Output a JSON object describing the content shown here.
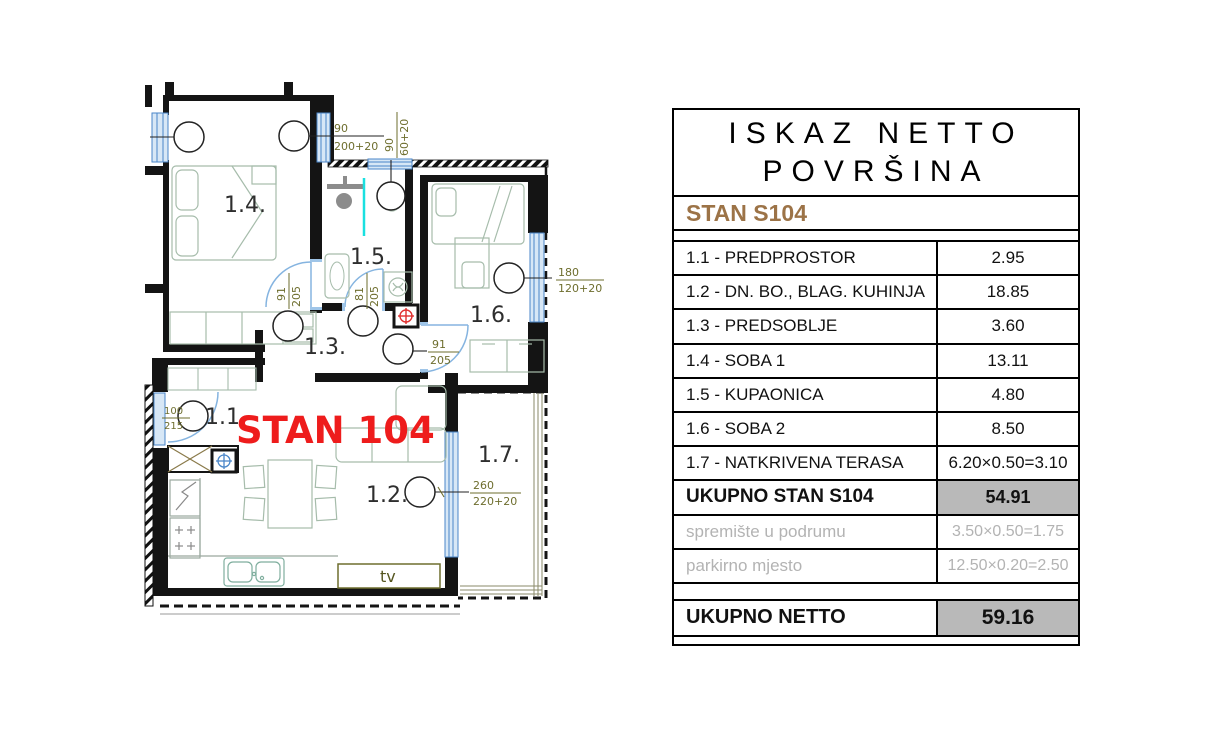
{
  "colors": {
    "accent_brown": "#9c7347",
    "highlight_red": "#ee1c1c",
    "total_cell_gray": "#b9b9b9",
    "muted_text": "#b3b3b3",
    "annotation_olive": "#6e6e2e",
    "window_blue": "#5b93c9"
  },
  "panel": {
    "title_line1": "ISKAZ NETTO",
    "title_line2": "POVRŠINA",
    "stan_label": "STAN S104",
    "rows": [
      {
        "label": "1.1 - PREDPROSTOR",
        "value": "2.95",
        "style": "normal"
      },
      {
        "label": "1.2 - DN. BO., BLAG. KUHINJA",
        "value": "18.85",
        "style": "normal"
      },
      {
        "label": "1.3 - PREDSOBLJE",
        "value": "3.60",
        "style": "normal"
      },
      {
        "label": "1.4 - SOBA 1",
        "value": "13.11",
        "style": "normal"
      },
      {
        "label": "1.5 - KUPAONICA",
        "value": "4.80",
        "style": "normal"
      },
      {
        "label": "1.6 - SOBA 2",
        "value": "8.50",
        "style": "normal"
      },
      {
        "label": "1.7 - NATKRIVENA TERASA",
        "value": "6.20×0.50=3.10",
        "style": "normal"
      },
      {
        "label": "UKUPNO STAN S104",
        "value": "54.91",
        "style": "total"
      },
      {
        "label": "spremište u podrumu",
        "value": "3.50×0.50=1.75",
        "style": "muted"
      },
      {
        "label": "parkirno mjesto",
        "value": "12.50×0.20=2.50",
        "style": "muted"
      }
    ],
    "netto": {
      "label": "UKUPNO NETTO",
      "value": "59.16"
    }
  },
  "plan": {
    "unit_label": "STAN 104",
    "tv_label": "tv",
    "rooms": {
      "r11": "1.1.",
      "r12": "1.2.",
      "r13": "1.3.",
      "r14": "1.4.",
      "r15": "1.5.",
      "r16": "1.6.",
      "r17": "1.7."
    },
    "dims": {
      "win_main": {
        "top": "90",
        "bottom": "200+20"
      },
      "win_bath": {
        "top": "90",
        "bottom": "60+20"
      },
      "win_soba2": {
        "top": "180",
        "bottom": "120+20"
      },
      "door_soba1": {
        "top": "91",
        "bottom": "205"
      },
      "door_bath": {
        "top": "81",
        "bottom": "205"
      },
      "door_soba2": {
        "top": "91",
        "bottom": "205"
      },
      "door_entry": {
        "top": "100",
        "bottom": "215"
      },
      "door_terrace": {
        "top": "260",
        "bottom": "220+20"
      }
    }
  }
}
